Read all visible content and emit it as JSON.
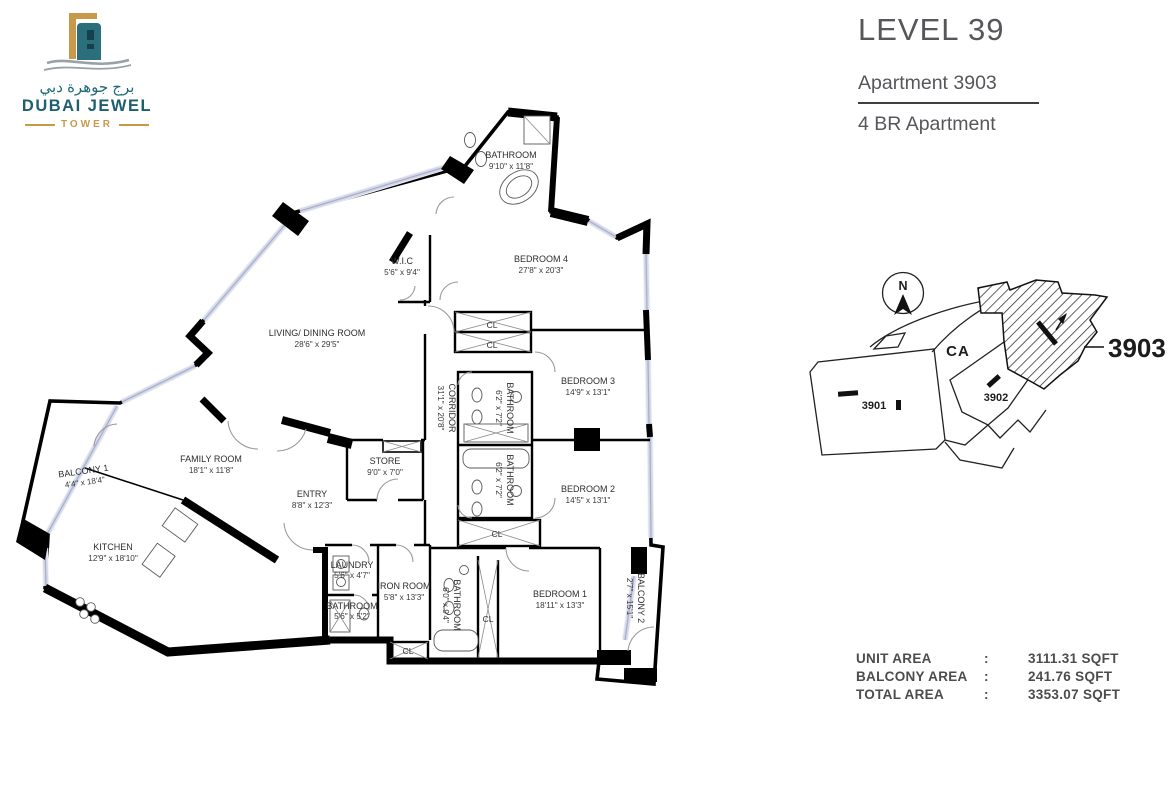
{
  "logo": {
    "arabic": "برج جوهرة دبي",
    "name": "DUBAI JEWEL",
    "subtitle": "TOWER"
  },
  "header": {
    "level": "LEVEL 39",
    "apartment": "Apartment 3903",
    "unit_type": "4 BR Apartment"
  },
  "plan": {
    "rooms": [
      {
        "label": "BATHROOM",
        "dims": "9'10\" x 11'8\""
      },
      {
        "label": "W.I.C",
        "dims": "5'6\" x 9'4\""
      },
      {
        "label": "BEDROOM 4",
        "dims": "27'8\" x 20'3\""
      },
      {
        "label": "LIVING/ DINING ROOM",
        "dims": "28'6\" x 29'5\""
      },
      {
        "label": "CORRIDOR",
        "dims": "31'1\" x 20'8\""
      },
      {
        "label": "BATHROOM",
        "dims": "6'2\" x 7'2\""
      },
      {
        "label": "BEDROOM 3",
        "dims": "14'9\" x 13'1\""
      },
      {
        "label": "BATHROOM",
        "dims": "6'2\" x 7'2\""
      },
      {
        "label": "BEDROOM 2",
        "dims": "14'5\" x 13'1\""
      },
      {
        "label": "FAMILY ROOM",
        "dims": "18'1\" x 11'8\""
      },
      {
        "label": "BALCONY 1",
        "dims": "4'4\" x 18'4\""
      },
      {
        "label": "STORE",
        "dims": "9'0\" x 7'0\""
      },
      {
        "label": "ENTRY",
        "dims": "8'8\" x 12'3\""
      },
      {
        "label": "KITCHEN",
        "dims": "12'9\" x 18'10\""
      },
      {
        "label": "LAUNDRY",
        "dims": "5'6\" x 4'7\""
      },
      {
        "label": "IRON ROOM",
        "dims": "5'8\" x 13'3\""
      },
      {
        "label": "BATHROOM",
        "dims": "5'6\" x 5'2\""
      },
      {
        "label": "BATHROOM",
        "dims": "6'0\" x 9'4\""
      },
      {
        "label": "BEDROOM 1",
        "dims": "18'11\" x 13'3\""
      },
      {
        "label": "BALCONY 2",
        "dims": "2'7\" x 15'1\""
      }
    ],
    "closet": "CL"
  },
  "keyplan": {
    "north": "N",
    "common_area": "CA",
    "unit_3901": "3901",
    "unit_3902": "3902",
    "unit_3903": "3903"
  },
  "areas": {
    "colon": ":",
    "rows": [
      {
        "label": "UNIT AREA",
        "value": "3111.31 SQFT"
      },
      {
        "label": "BALCONY AREA",
        "value": "241.76 SQFT"
      },
      {
        "label": "TOTAL AREA",
        "value": "3353.07 SQFT"
      }
    ]
  },
  "colors": {
    "teal": "#1d6a78",
    "gold": "#c9994a",
    "window": "#a9afcc"
  }
}
